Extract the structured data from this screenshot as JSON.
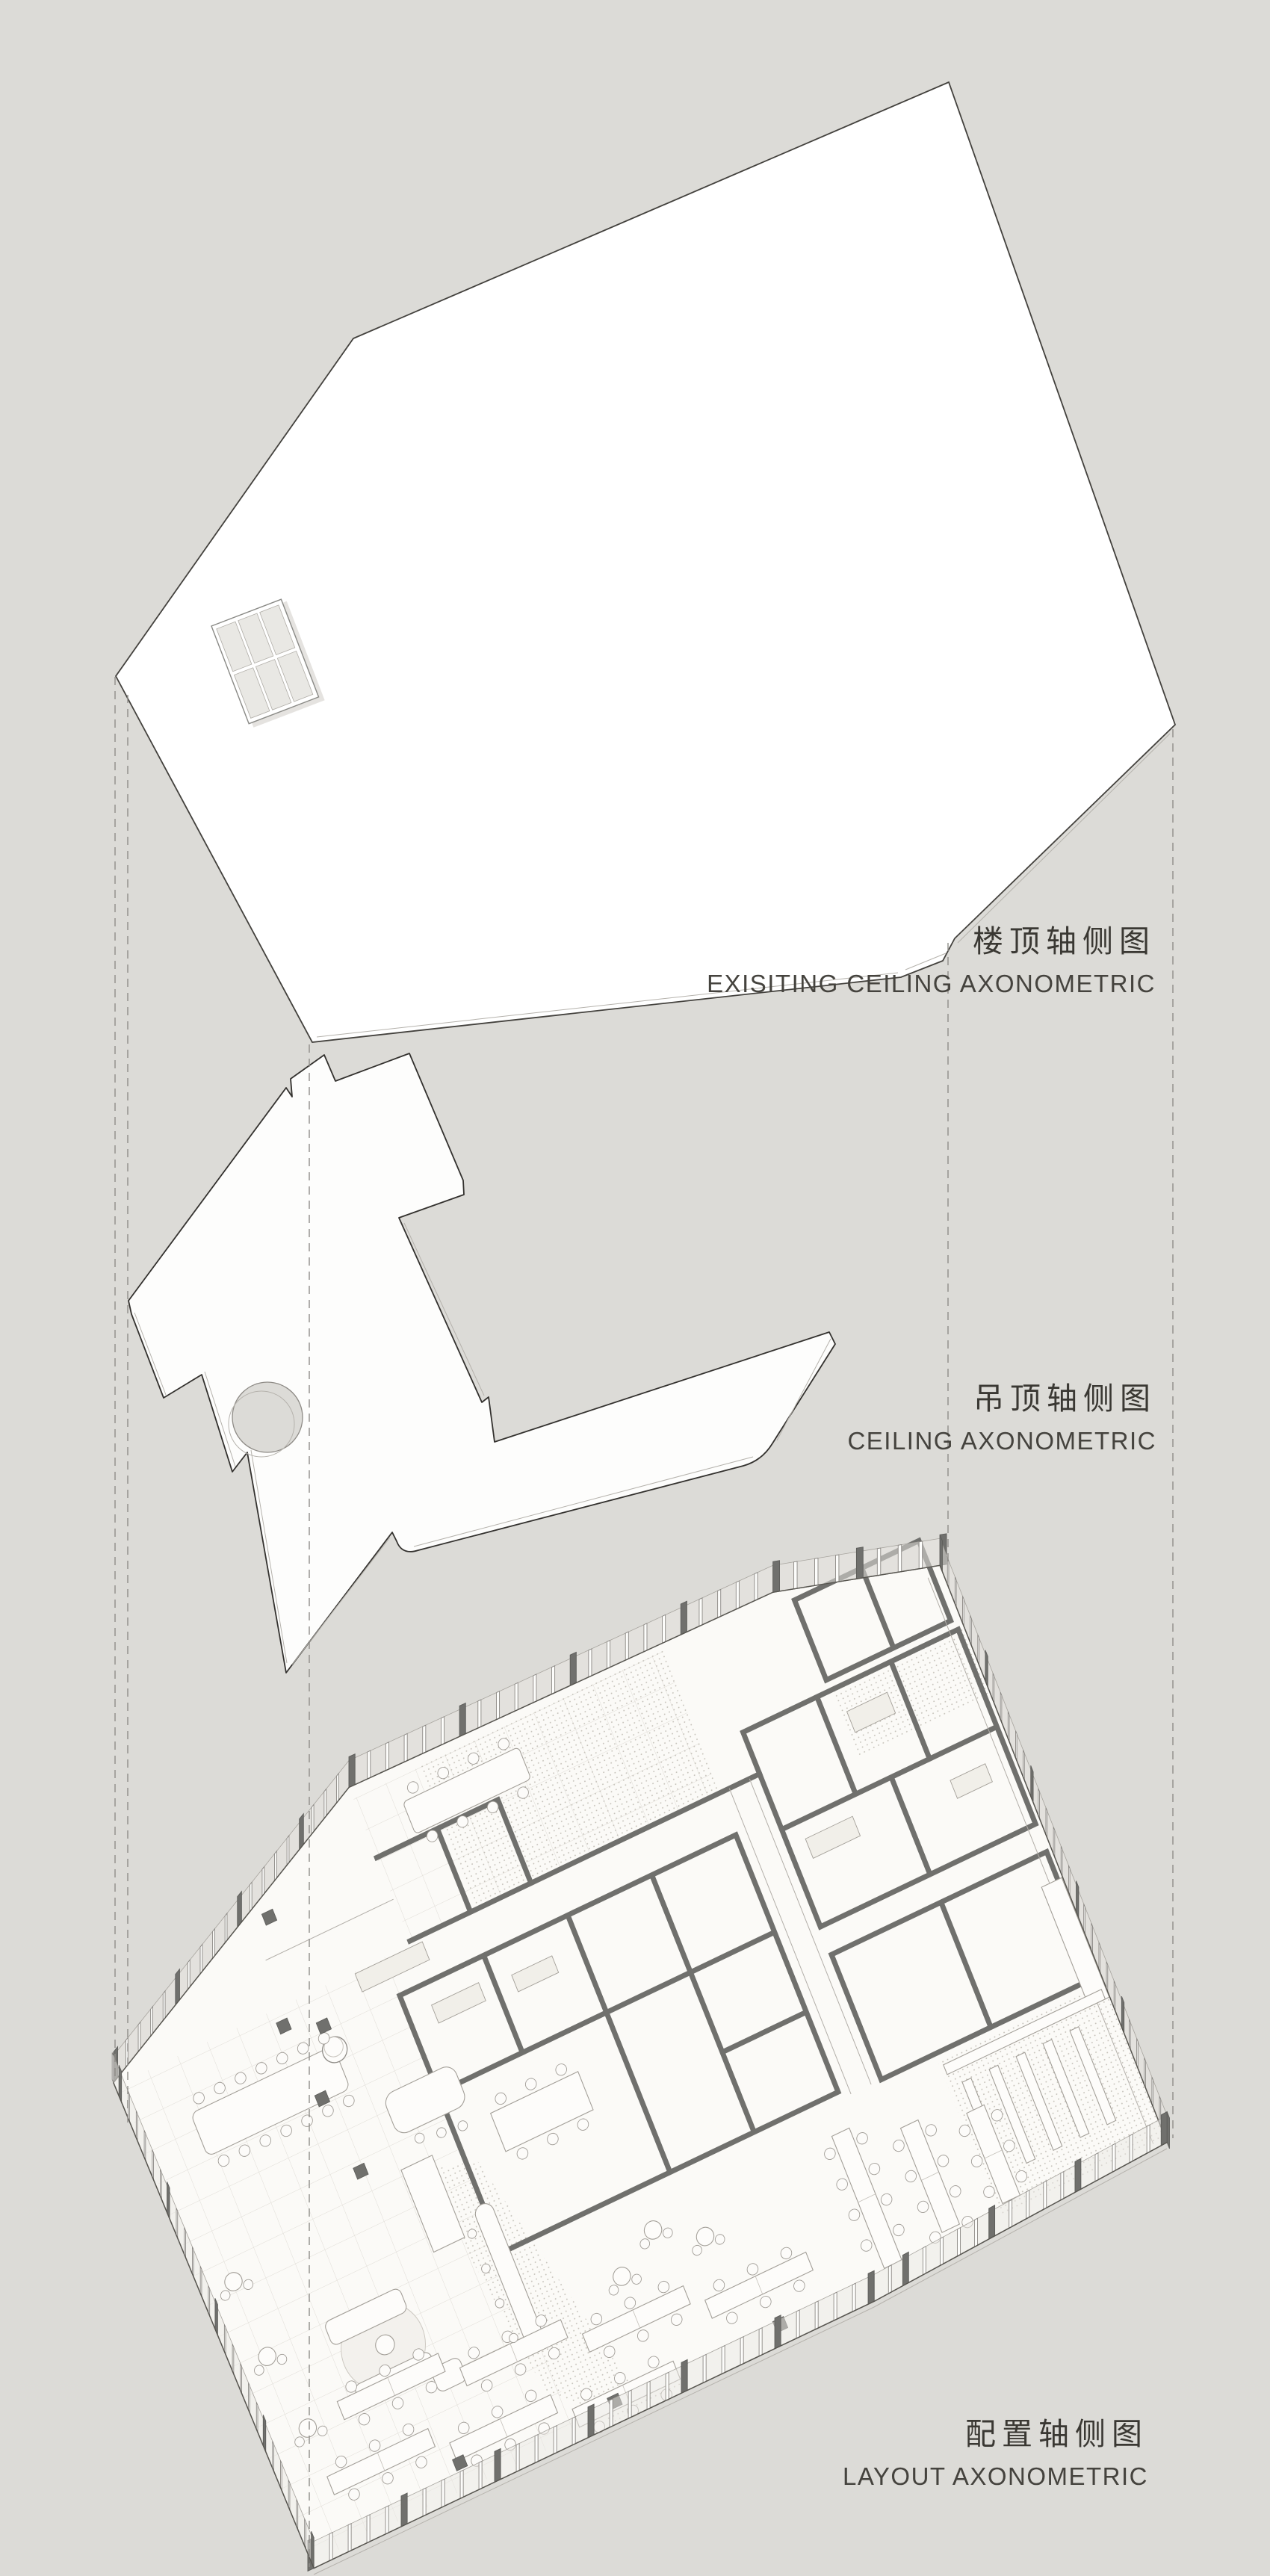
{
  "page": {
    "title": "exploded axonometric diagram",
    "background": "#dcdbd7"
  },
  "colors": {
    "background": "#dcdbd7",
    "ink": "#3a3833",
    "outline": "#43413d",
    "wall_gray": "#70706d",
    "dash_gray": "#8f8d89",
    "floor_white": "#fbfaf7",
    "glass_pane": "#e9e8e4",
    "dot_texture": "#c3bfb7",
    "tile_line": "#d9d5ce"
  },
  "labels": {
    "existing_ceiling": {
      "zh": "楼顶轴侧图",
      "en": "EXISITING CEILING  AXONOMETRIC"
    },
    "ceiling": {
      "zh": "吊顶轴侧图",
      "en": "CEILING AXONOMETRIC"
    },
    "layout": {
      "zh": "配置轴侧图",
      "en": "LAYOUT AXONOMETRIC"
    }
  },
  "layers": [
    {
      "name": "existing-ceiling-roof",
      "features": [
        "roof slab",
        "skylight grid 3x2"
      ]
    },
    {
      "name": "suspended-ceiling",
      "features": [
        "arrow-shaped ceiling panel",
        "round light hole"
      ]
    },
    {
      "name": "furnished-layout",
      "features": [
        "perimeter glazing fins",
        "meeting rooms",
        "open office desks",
        "lobby lounge",
        "library shelves"
      ]
    }
  ]
}
